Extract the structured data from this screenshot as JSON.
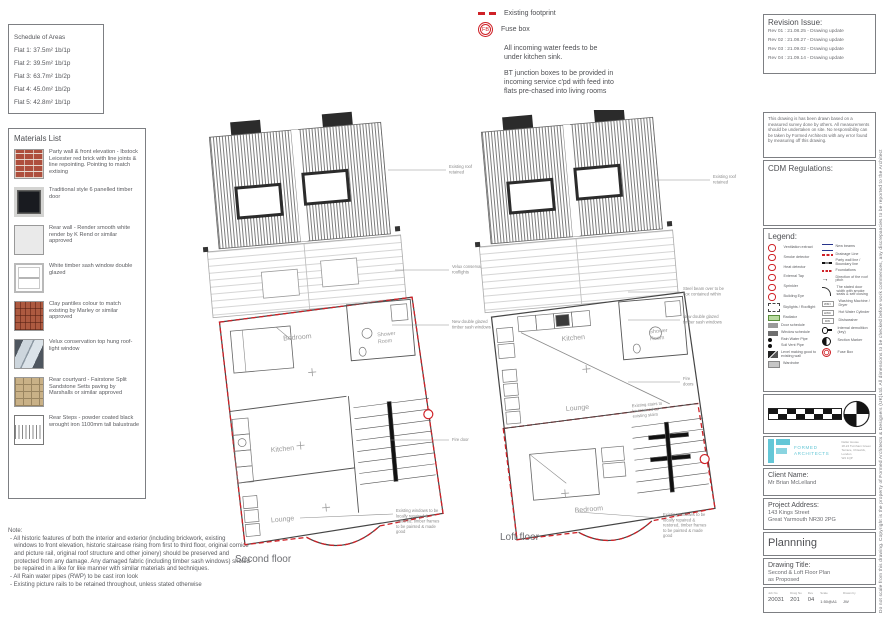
{
  "schedule": {
    "title": "Schedule of Areas",
    "flats": [
      "Flat 1: 37.5m² 1b/1p",
      "Flat 2: 39.5m² 1b/1p",
      "Flat 3: 63.7m² 1b/2p",
      "Flat 4: 45.0m² 1b/2p",
      "Flat 5: 42.8m² 1b/1p"
    ]
  },
  "materials": {
    "title": "Materials List",
    "items": [
      "Party wall & front elevation - Ibstock Leicester red brick with line joints & line repointing. Pointing to match extising",
      "Traditional style 6 panelled timber door",
      "Rear wall - Render smooth white render by K Rend or similar approved",
      "White timber sash window double glazed",
      "Clay pantiles colour to match existing by Marley or similar approved",
      "Velux conservation top hung roof- light window",
      "Rear courtyard - Fairstone Split Sandstone Setts paving by Marshalls or similar approved",
      "Rear Steps - powder coated black wrought iron 1100mm tall balustrade"
    ]
  },
  "note": {
    "title": "Note:",
    "bullets": [
      "- All historic features of both the interior and exterior (including brickwork, existing windows to front elevation, historic staircase rising from first to third floor, original cornice and picture rail, original roof structure and other joinery) should be preserved and protected from any damage. Any damaged fabric (including timber sash windows) should be repaired in a like for like manner with similar materials and techniques.",
      "- All Rain water pipes (RWP) to be cast iron look",
      "- Existing picture rails to be retained throughout, unless stated otherwise"
    ]
  },
  "key_notes": {
    "existing_footprint": "Existing footprint",
    "fuse_box_abbr": "FB",
    "fuse_box": "Fuse box",
    "water": "All incoming water feeds to be\nunder kitchen sink.",
    "bt": "BT junction boxes to be provided in\nincoming service c'pd with feed into\nflats pre-chased into living rooms"
  },
  "plans": {
    "second": {
      "caption": "Second floor",
      "rooms": {
        "bedroom": "Bedroom",
        "shower1": "Shower",
        "shower2": "Room",
        "kitchen": "Kitchen",
        "lounge": "Lounge"
      },
      "ann": {
        "roof": "Existing roof\nretained",
        "rooflights": "Velux conservation\nrooflights",
        "windows": "New double glazed\ntimber sash windows",
        "fire": "Fire door",
        "bay": "Existing windows to be\nlocally repaired &\nrestored, timber frames\nto be painted & made\ngood"
      }
    },
    "loft": {
      "caption": "Loft floor",
      "rooms": {
        "kitchen": "Kitchen",
        "shower1": "Shower",
        "shower2": "Room",
        "lounge": "Lounge",
        "bedroom": "Bedroom"
      },
      "ann": {
        "roof": "Existing roof\nretained",
        "beam": "Steel beam over to be\nbox contained within",
        "windows": "New double glazed\ntimber sash windows",
        "fire": "Fire\ndoors",
        "stairs": "Existing stairs to\nbe retained as\nexisting stairs",
        "bay": "Existing windows to be\nlocally repaired &\nrestored, timber frames\nto be painted & made\ngood"
      }
    }
  },
  "titleblock": {
    "revision": {
      "title": "Revision Issue:",
      "rows": [
        "Rev 01 : 21.08.25 - Drawing update",
        "Rev 02 : 21.08.27 - Drawing update",
        "Rev 03 : 21.09.02 - Drawing update",
        "Rev 04 : 21.09.14 - Drawing update"
      ]
    },
    "disclaimer": "This drawing is has been drawn based on a measured survey done by others. All measurements should be undertaken on site. No responsibility can be taken by Formed Architects with any error found by measuring off this drawing.",
    "cdm_title": "CDM Regulations:",
    "legend": {
      "title": "Legend:",
      "left": [
        "Ventilation extract",
        "Smoke detector",
        "Heat detector",
        "External Tap",
        "Sprinkler",
        "Building Eye",
        "Skylights / Rooflight",
        "Radiator",
        "Door schedule",
        "Window schedule",
        "Rain Water Pipe",
        "Soil Vent Pipe",
        "Level making good to existing wall",
        "Wardrobe"
      ],
      "right": [
        "New beams",
        "Drainage Line",
        "Party wall line / Boundary line",
        "Foundations",
        "Direction of the roof pitch",
        "The stated door width with smoke seals & self closing",
        "Washing Machine / Dryer",
        "Hot Water Cylinder",
        "Dishwasher",
        "Internal demolition (key)",
        "Section Marker",
        "Fuse Box"
      ],
      "tags": {
        "wm": "WM /",
        "hwc": "HWC",
        "dw": "DW"
      }
    },
    "firm": {
      "name_line1": "FORMED",
      "name_line2": "ARCHITECTS",
      "address": "Deller House\n18-24 Turnham Green\nTerrace, Chiswick,\nLondon\nW4 1QP"
    },
    "client": {
      "title": "Client Name:",
      "name": "Mr Brian McLelland"
    },
    "project": {
      "title": "Project Address:",
      "line1": "143 Kings Street",
      "line2": "Great Yarmouth NR30 2PG"
    },
    "stage": "Plannning",
    "drawing": {
      "title": "Drawing Title:",
      "line1": "Second & Loft Floor Plan",
      "line2": "as Proposed"
    },
    "meta": {
      "job_label": "Job No",
      "job": "20031",
      "drwg_label": "Drwg No",
      "drwg": "201",
      "rev_label": "Rev",
      "rev": "04",
      "scale_label": "Scale",
      "scale": "1:50@A1",
      "drawn_label": "Drawn by",
      "drawn": "JW"
    }
  },
  "edge_text": "Do not scale from this drawing. Copyright is the property of Formed Architects & Designers (UK)Ltd. All dimensions to be checked before work commences, any discrepancies to be reported to the Architect"
}
